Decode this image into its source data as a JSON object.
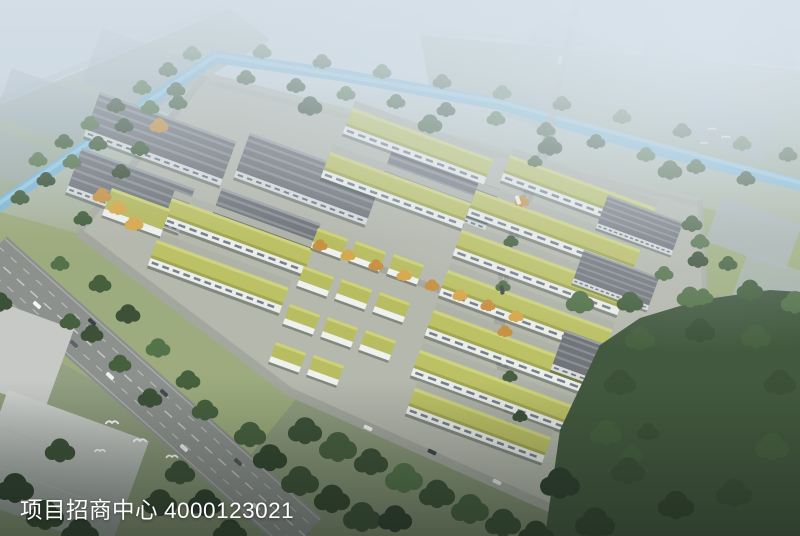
{
  "caption": {
    "label": "项目招商中心",
    "phone": "4000123021",
    "text_color": "#ffffff"
  },
  "scene": {
    "type": "aerial-architectural-rendering",
    "description": "Bird's-eye rendering of an industrial park: grey ridged-roof warehouses along a tree-lined blue canal, rows of white multi-storey workshops with yellow-green planted roofs, small villa-style offices in the centre, autumn-tree avenues, a wide arterial road with traffic at lower left, large flat grey-roofed buildings and dense forest outside the park, hazy sky toward the horizon, white birds in flight",
    "palette": {
      "haze_sky": "#cbd7e0",
      "canal_water": "#7eb9d6",
      "warehouse_roof": "#71757a",
      "workshop_roof": "#bcc166",
      "workshop_facade": "#ebedea",
      "tree_dark": "#3c5138",
      "tree_autumn": "#c89245",
      "lawn": "#9dac7d",
      "road": "#8d918e",
      "distant_building": "#9fadb9"
    }
  }
}
